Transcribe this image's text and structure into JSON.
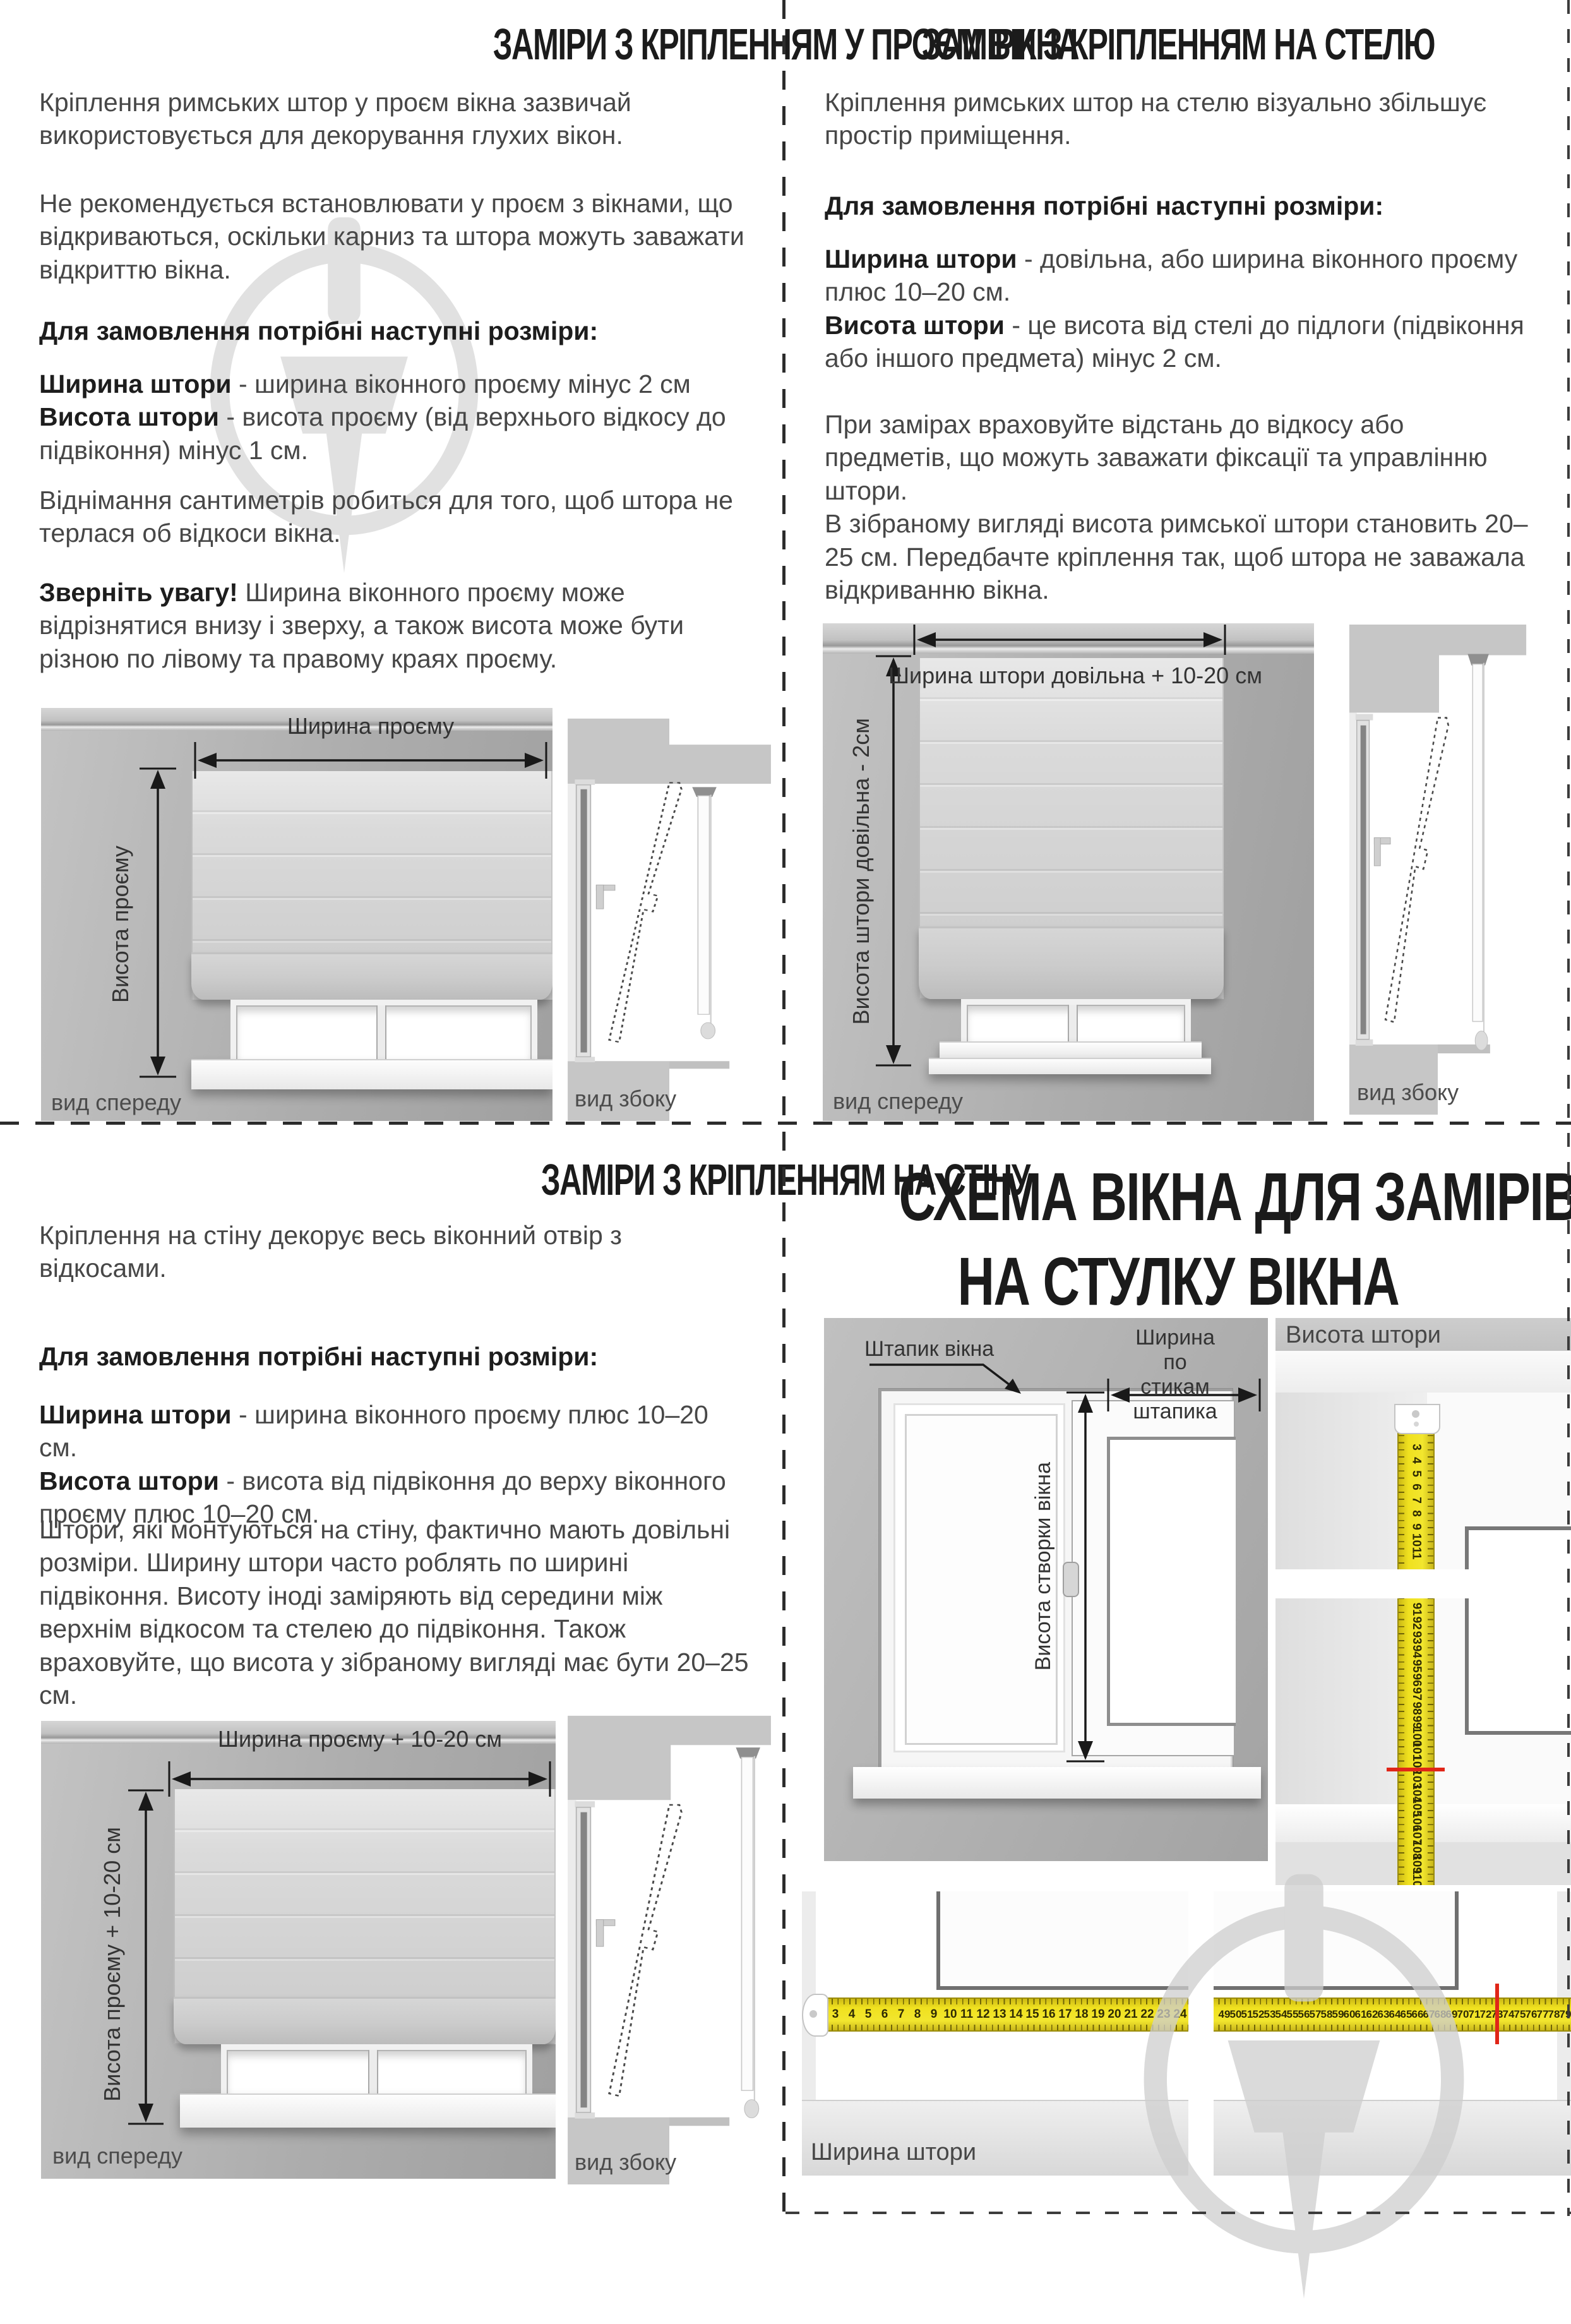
{
  "q1": {
    "title": "ЗАМІРИ З КРІПЛЕННЯМ У ПРОЄМ ВІКНА",
    "p1": "Кріплення римських штор у проєм вікна зазвичай використовується для декорування глухих вікон.",
    "p2": "Не рекомендується встановлювати у проєм з вікнами, що відкриваються, оскільки карниз та штора можуть заважати відкриттю вікна.",
    "p3": [
      {
        "t": "Для замовлення потрібні наступні розміри:",
        "b": true
      }
    ],
    "p4": [
      {
        "t": "Ширина штори",
        "b": true
      },
      {
        "t": " - ширина віконного проєму мінус 2 см\n",
        "b": false
      },
      {
        "t": "Висота штори",
        "b": true
      },
      {
        "t": " - висота проєму (від верхнього відкосу до підвіконня) мінус 1 см.",
        "b": false
      }
    ],
    "p5": "Віднімання сантиметрів робиться для того, щоб штора не терлася об відкоси вікна.",
    "p6": [
      {
        "t": "Зверніть увагу!",
        "b": true
      },
      {
        "t": " Ширина віконного проєму може відрізнятися внизу і зверху, а також висота може бути різною по лівому та правому краях проєму.",
        "b": false
      }
    ],
    "width_label": "Ширина проєму",
    "height_label": "Висота проєму",
    "front_label": "вид спереду",
    "side_label": "вид збоку"
  },
  "q2": {
    "title": "ЗАМІРИ З КРІПЛЕННЯМ НА СТЕЛЮ",
    "p1": "Кріплення римських штор на стелю візуально збільшує простір приміщення.",
    "p2": [
      {
        "t": "Для замовлення потрібні наступні розміри:",
        "b": true
      }
    ],
    "p3": [
      {
        "t": "Ширина штори",
        "b": true
      },
      {
        "t": " - довільна, або ширина віконного проєму плюс 10–20 см.\n",
        "b": false
      },
      {
        "t": "Висота штори",
        "b": true
      },
      {
        "t": " - це висота від стелі до підлоги (підвіконня або іншого предмета) мінус 2 см.",
        "b": false
      }
    ],
    "p4": "При замірах враховуйте відстань до відкосу або предметів, що можуть заважати фіксації та управлінню штори.\nВ зібраному вигляді висота римської штори становить 20–25 см. Передбачте кріплення так, щоб штора не заважала відкриванню вікна.",
    "width_label": "Ширина штори довільна + 10-20 см",
    "height_label": "Висота штори довільна - 2см",
    "front_label": "вид спереду",
    "side_label": "вид збоку"
  },
  "q3": {
    "title": "ЗАМІРИ З КРІПЛЕННЯМ НА СТІНУ",
    "p1": "Кріплення на стіну декорує весь віконний отвір з відкосами.",
    "p2": [
      {
        "t": "Для замовлення потрібні наступні розміри:",
        "b": true
      }
    ],
    "p3": [
      {
        "t": "Ширина штори",
        "b": true
      },
      {
        "t": " - ширина віконного проєму плюс 10–20 см.\n",
        "b": false
      },
      {
        "t": "Висота штори",
        "b": true
      },
      {
        "t": " - висота від підвіконня до верху віконного проєму плюс 10–20 см.",
        "b": false
      }
    ],
    "p4": "Штори, які монтуються на стіну, фактично мають довільні розміри. Ширину штори часто роблять по ширині підвіконня. Висоту іноді заміряють від середини між верхнім відкосом та стелею до підвіконня. Також враховуйте, що висота у зібраному вигляді має бути 20–25 см.",
    "width_label": "Ширина проєму + 10-20 см",
    "height_label": "Висота проєму + 10-20 см",
    "front_label": "вид спереду",
    "side_label": "вид збоку"
  },
  "q4": {
    "title_line1": "СХЕМА ВІКНА ДЛЯ ЗАМІРІВ",
    "title_line2": "НА СТУЛКУ ВІКНА",
    "bead_label": "Штапик вікна",
    "bead_width_label": "Ширина по стикам\nштапика",
    "sash_height_label": "Висота створки вікна",
    "curtain_height_label": "Висота штори",
    "curtain_width_label": "Ширина штори",
    "height_tape_top": [
      "3",
      "4",
      "5",
      "6",
      "7",
      "8",
      "9",
      "10",
      "11"
    ],
    "height_tape_bottom": [
      "91",
      "92",
      "93",
      "94",
      "95",
      "96",
      "97",
      "98",
      "99",
      "100",
      "101",
      "102",
      "103",
      "104",
      "105",
      "106",
      "107",
      "108",
      "109",
      "110"
    ],
    "width_tape_left": [
      "3",
      "4",
      "5",
      "6",
      "7",
      "8",
      "9",
      "10",
      "11",
      "12",
      "13",
      "14",
      "15",
      "16",
      "17",
      "18",
      "19",
      "20",
      "21",
      "22",
      "23",
      "24"
    ],
    "width_tape_right": [
      "49",
      "50",
      "51",
      "52",
      "53",
      "54",
      "55",
      "56",
      "57",
      "58",
      "59",
      "60",
      "61",
      "62",
      "63",
      "64",
      "65",
      "66",
      "67",
      "68",
      "69",
      "70",
      "71",
      "72",
      "73",
      "74",
      "75",
      "76",
      "77",
      "78",
      "79"
    ]
  },
  "colors": {
    "tape_yellow": "#f0e11f",
    "mark_red": "#e02618",
    "wall_gray": "#b0b0b0",
    "watermark_gray": "#dcdcdc"
  }
}
